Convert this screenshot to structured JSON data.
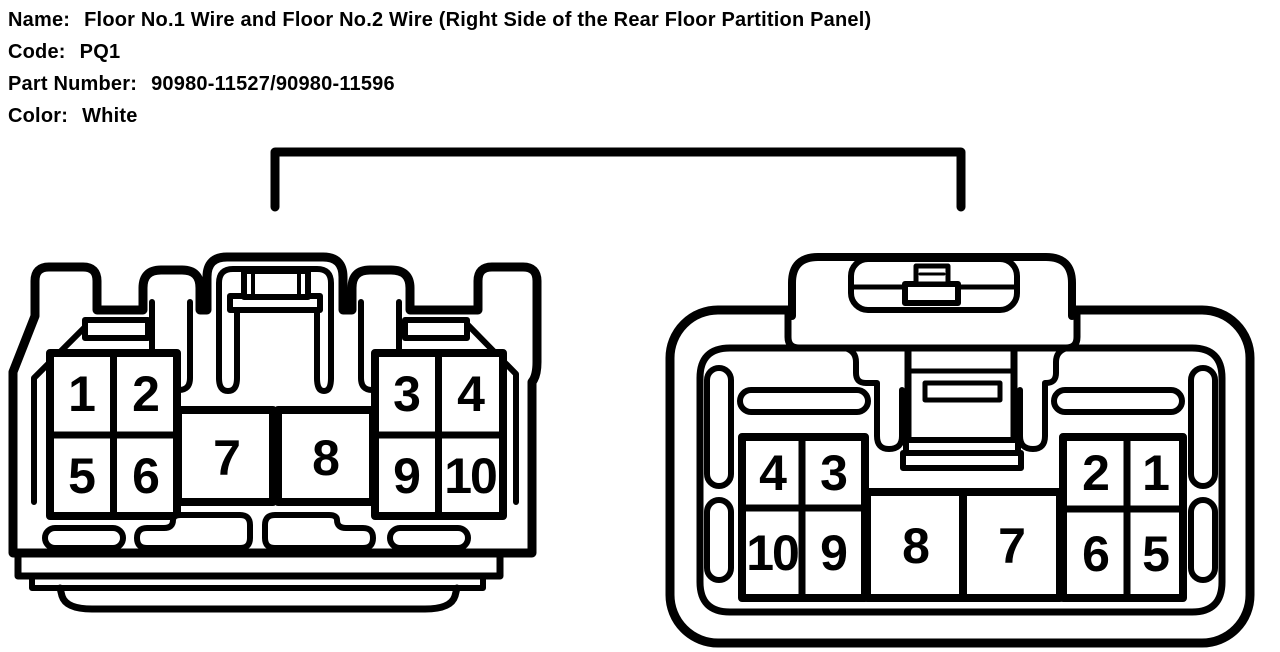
{
  "header": {
    "fields": [
      {
        "label": "Name:",
        "value": "Floor No.1 Wire and Floor No.2 Wire (Right Side of the Rear Floor Partition Panel)"
      },
      {
        "label": "Code:",
        "value": "PQ1"
      },
      {
        "label": "Part Number:",
        "value": "90980-11527/90980-11596"
      },
      {
        "label": "Color:",
        "value": "White"
      }
    ]
  },
  "diagram": {
    "colors": {
      "line": "#000000",
      "background": "#ffffff"
    },
    "left_connector": {
      "pins": [
        "1",
        "2",
        "5",
        "6",
        "7",
        "8",
        "3",
        "4",
        "9",
        "10"
      ]
    },
    "right_connector": {
      "pins": [
        "4",
        "3",
        "10",
        "9",
        "8",
        "7",
        "2",
        "1",
        "6",
        "5"
      ]
    }
  }
}
